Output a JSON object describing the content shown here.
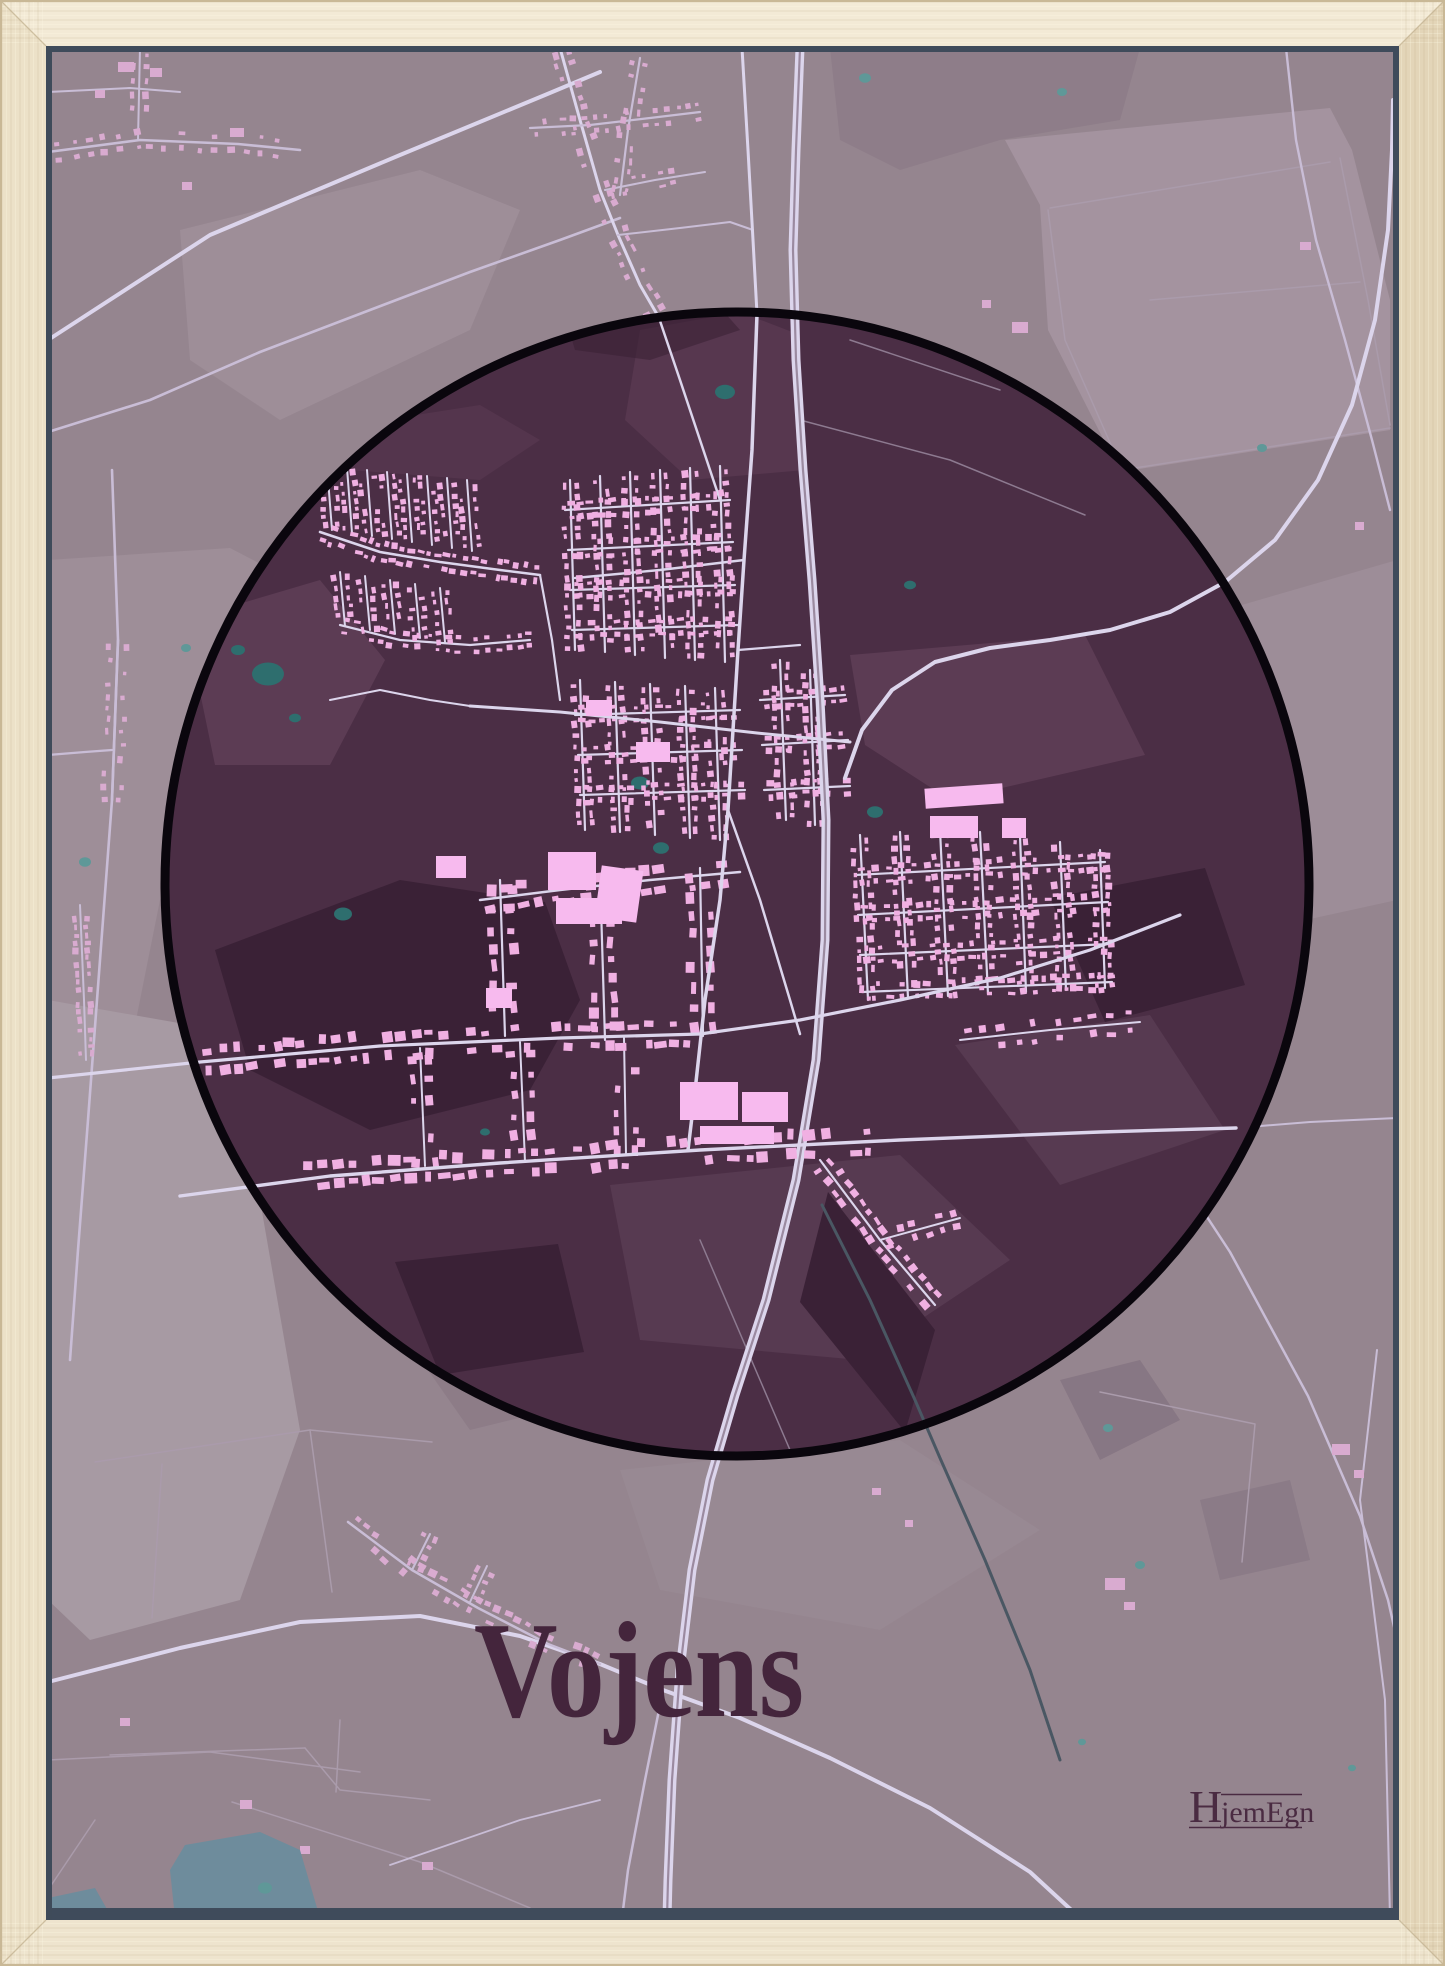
{
  "poster": {
    "title": "Vojens",
    "brand": {
      "initial": "H",
      "rest": "jemEgn"
    },
    "colors": {
      "wood_top": "#f3ead6",
      "wood_left": "#ece1c8",
      "wood_right": "#e3d5b8",
      "wood_bottom": "#eee4ce",
      "wood_edge": "#c9b896",
      "shadow": "#3f4b5b",
      "bg": "#95858f",
      "field_light": "#a79aa3",
      "field_light2": "#a4939f",
      "field_mid": "#9e8e98",
      "field_dark": "#82717f",
      "circle_fill": "#4b2e45",
      "circle_stroke": "#0a060d",
      "in_dark": "#3a2136",
      "in_light": "#5c3c54",
      "in_light2": "#573a51",
      "road": "#dcd5ec",
      "road_minor": "#c9bdd6",
      "road_thin": "#aa9bab",
      "road_in_thin": "#8d7a90",
      "bld_in": "#f0b0e2",
      "bld_big": "#f7baee",
      "bld_out": "#d9abd0",
      "pond": "#2e6e6e",
      "pond_out": "#5f9898",
      "water": "#6e8c9c",
      "stream": "#4a5763",
      "title_color": "#44253c",
      "brand_color": "#4a2b42"
    }
  }
}
